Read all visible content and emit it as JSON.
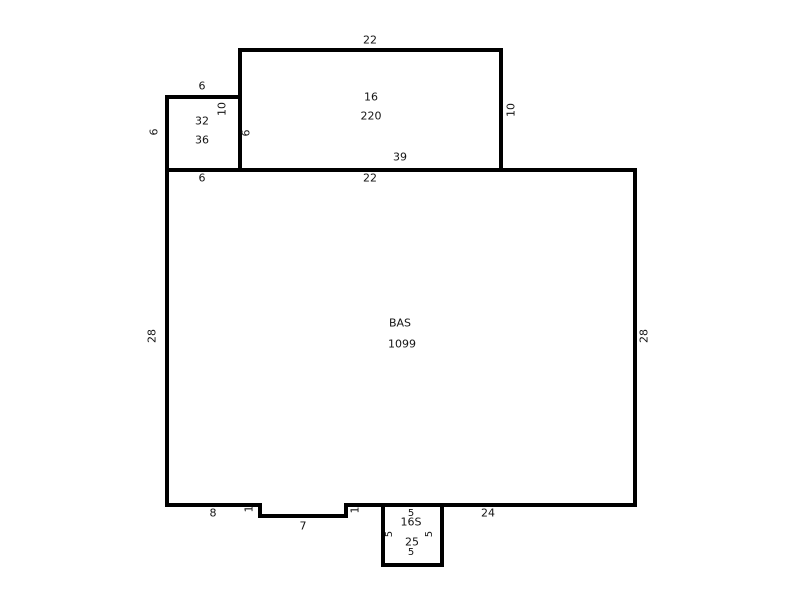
{
  "sketch": {
    "background": "#ffffff",
    "line_color": "#000000",
    "text_color": "#141414",
    "areas": {
      "bas": {
        "code": "BAS",
        "area": "1099"
      },
      "porch": {
        "code": "16",
        "area": "220"
      },
      "addition": {
        "code": "32",
        "area": "36"
      },
      "stoop": {
        "code": "16S",
        "area": "25"
      }
    },
    "dimensions": {
      "porch_top": "22",
      "porch_left": "10",
      "porch_right": "10",
      "addition_top": "6",
      "addition_left": "6",
      "addition_right": "6",
      "addition_bottom": "6",
      "bas_top": "39",
      "bas_top_under_porch": "22",
      "bas_left": "28",
      "bas_right": "28",
      "bas_bottom_left": "8",
      "notch_left": "1",
      "notch_bottom": "7",
      "notch_right": "1",
      "bas_bottom_right": "24",
      "stoop_top": "5",
      "stoop_left": "5",
      "stoop_right": "5",
      "stoop_bottom": "5"
    }
  }
}
